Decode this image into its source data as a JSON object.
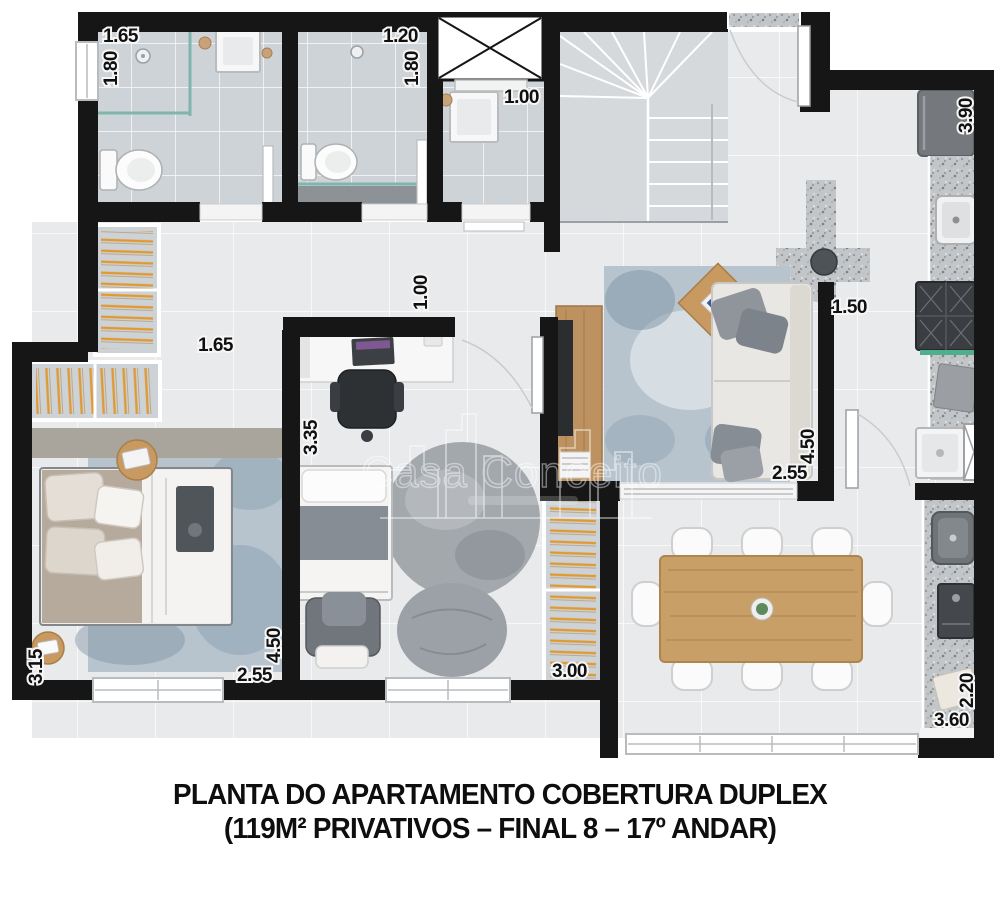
{
  "watermark": {
    "brand": "Casa Conceito"
  },
  "caption": {
    "line1": "PLANTA DO APARTAMENTO COBERTURA DUPLEX",
    "line2": "(119M² PRIVATIVOS – FINAL 8 – 17º ANDAR)"
  },
  "dimensions": {
    "bathroom1": {
      "width": "1.65",
      "depth": "1.80"
    },
    "bathroom2": {
      "width": "1.20",
      "depth": "1.80"
    },
    "lavabo": {
      "width": "1.00"
    },
    "kitchen": {
      "length": "3.90"
    },
    "closet_corridor": {
      "width": "1.65"
    },
    "office": {
      "door": "1.00",
      "depth": "3.35"
    },
    "kitchen_corridor": {
      "width": "1.50"
    },
    "living": {
      "depth": "4.50",
      "width": "2.55"
    },
    "master_bedroom": {
      "side": "3.15",
      "width": "2.55",
      "depth": "4.50"
    },
    "bedroom2": {
      "width": "3.00"
    },
    "balcony": {
      "width": "2.20",
      "length": "3.60"
    }
  },
  "colors": {
    "wall": "#161616",
    "floor": "#e9eaec",
    "bath_tile": "#ced3d7",
    "granite": "#c3c6c8",
    "hanger_orange": "#e09a35",
    "wood": "#c89a62",
    "glass_teal": "#7fb5ad",
    "rug_blue": "#b7c3cd",
    "text": "#101010"
  }
}
